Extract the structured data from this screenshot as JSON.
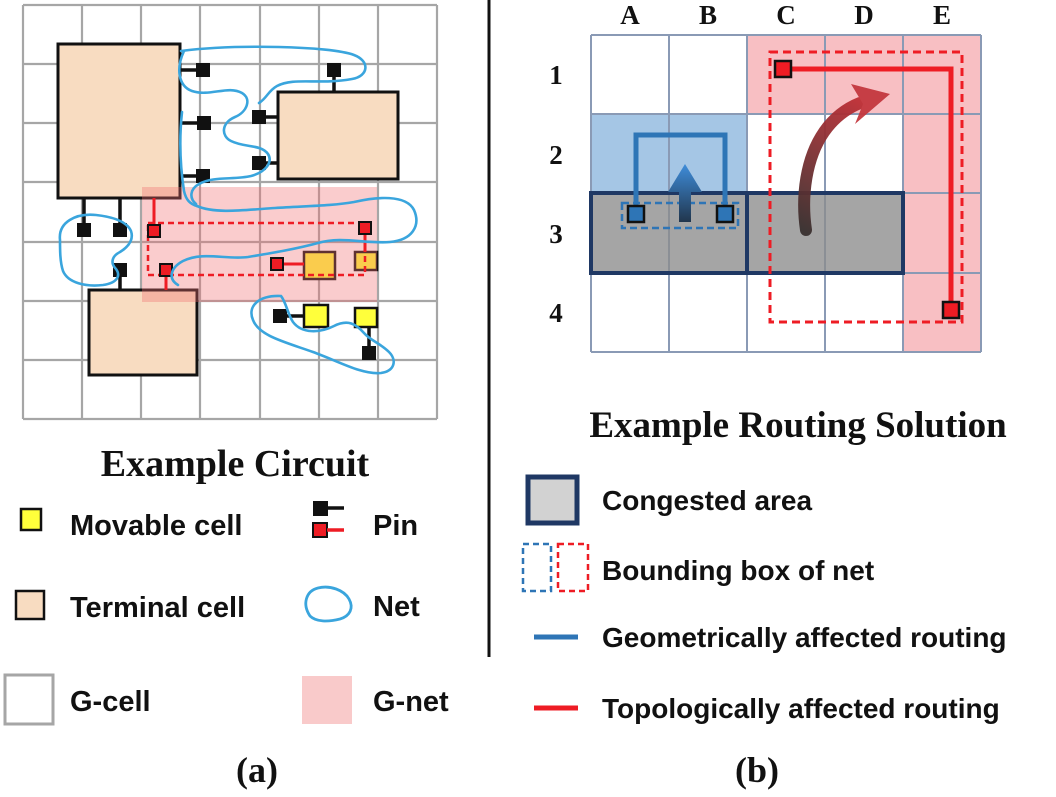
{
  "left_panel": {
    "title": "Example Circuit",
    "caption": "(a)",
    "legend": {
      "movable_cell": "Movable cell",
      "pin": "Pin",
      "terminal_cell": "Terminal cell",
      "net": "Net",
      "g_cell": "G-cell",
      "g_net": "G-net"
    }
  },
  "right_panel": {
    "title": "Example Routing Solution",
    "caption": "(b)",
    "column_labels": [
      "A",
      "B",
      "C",
      "D",
      "E"
    ],
    "row_labels": [
      "1",
      "2",
      "3",
      "4"
    ],
    "legend": {
      "congested_area": "Congested area",
      "bounding_box": "Bounding box of net",
      "geometric_routing": "Geometrically affected routing",
      "topological_routing": "Topologically affected routing"
    }
  },
  "colors": {
    "net_blue": "#3aa5dd",
    "routing_blue": "#2e75b6",
    "routing_red": "#ee1c24",
    "congested_border_navy": "#1f3864",
    "congested_gray": "#a9a9a9",
    "terminal_peach": "#f8dcc1",
    "movable_yellow": "#ffff3b",
    "g_net_pink": "#f9caca",
    "routing_pink_cell": "#f8bfc3",
    "routing_blue_cell": "#a5c6e5",
    "grid_gray": "#a6a6a6",
    "right_grid_blue_gray": "#8a9ab5"
  }
}
